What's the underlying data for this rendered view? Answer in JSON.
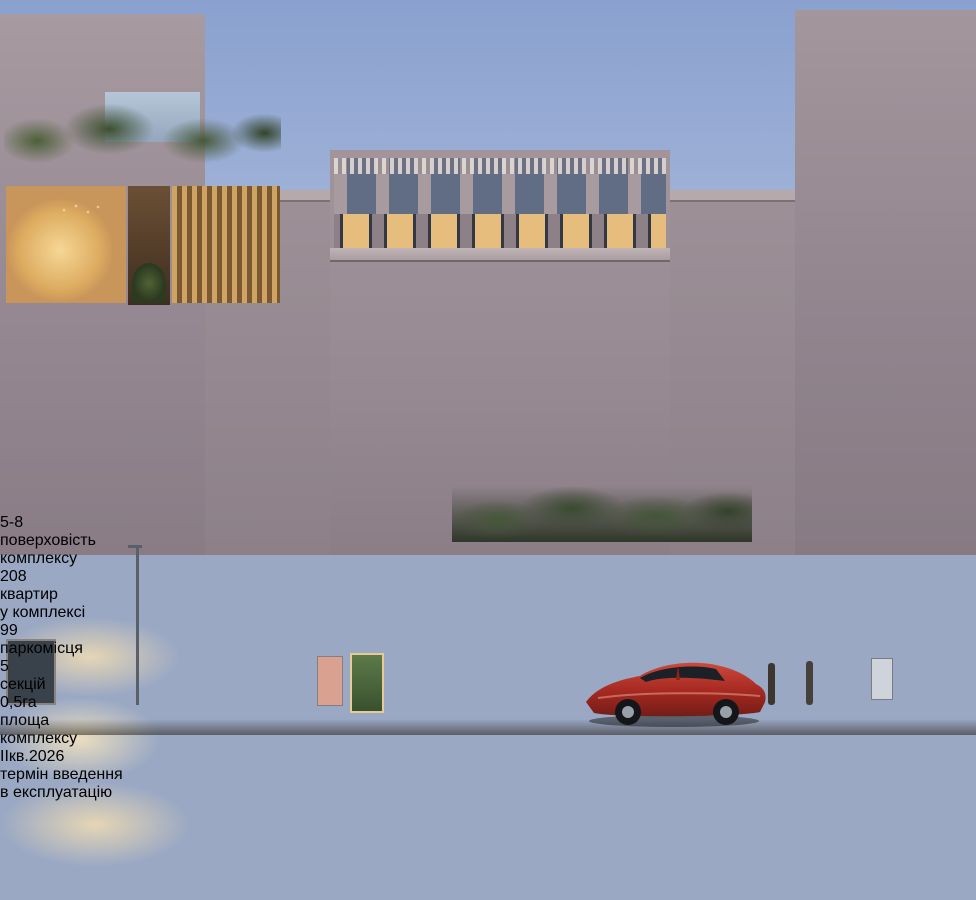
{
  "signs": {
    "planet": {
      "line1": "PLANET",
      "line2": ""
    },
    "eco": {
      "line1": "ECO",
      "line2": "market"
    },
    "clothes": {
      "line1": "CLOTHES",
      "line2": "fashion"
    }
  },
  "stats": [
    {
      "big": "5-8",
      "small": "",
      "big2": "",
      "label1": "поверховість",
      "label2": "комплексу"
    },
    {
      "big": "208",
      "small": "",
      "big2": "",
      "label1": "квартир",
      "label2": "у комплексі"
    },
    {
      "big": "99",
      "small": "",
      "big2": "",
      "label1": "паркомісця",
      "label2": ""
    },
    {
      "big": "5",
      "small": "",
      "big2": "",
      "label1": "секцій",
      "label2": ""
    },
    {
      "big": "0,5",
      "small": "га",
      "big2": "",
      "label1": "площа",
      "label2": "комплексу"
    },
    {
      "big": "II",
      "small": "кв.",
      "big2": "2026",
      "label1": "термін введення",
      "label2": "в експлуатацію"
    }
  ],
  "colors": {
    "sky_top": "#8aa1cf",
    "sky_bottom": "#c3cee6",
    "facade": "#9a8c91",
    "warm_window": "#e7bd7e",
    "storefront_glow": "#e3bd83",
    "sign_bronze": "#c9a883",
    "car_red": "#b5322a",
    "hedge_dark": "#222b1e",
    "stats_text": "#ffffff"
  }
}
